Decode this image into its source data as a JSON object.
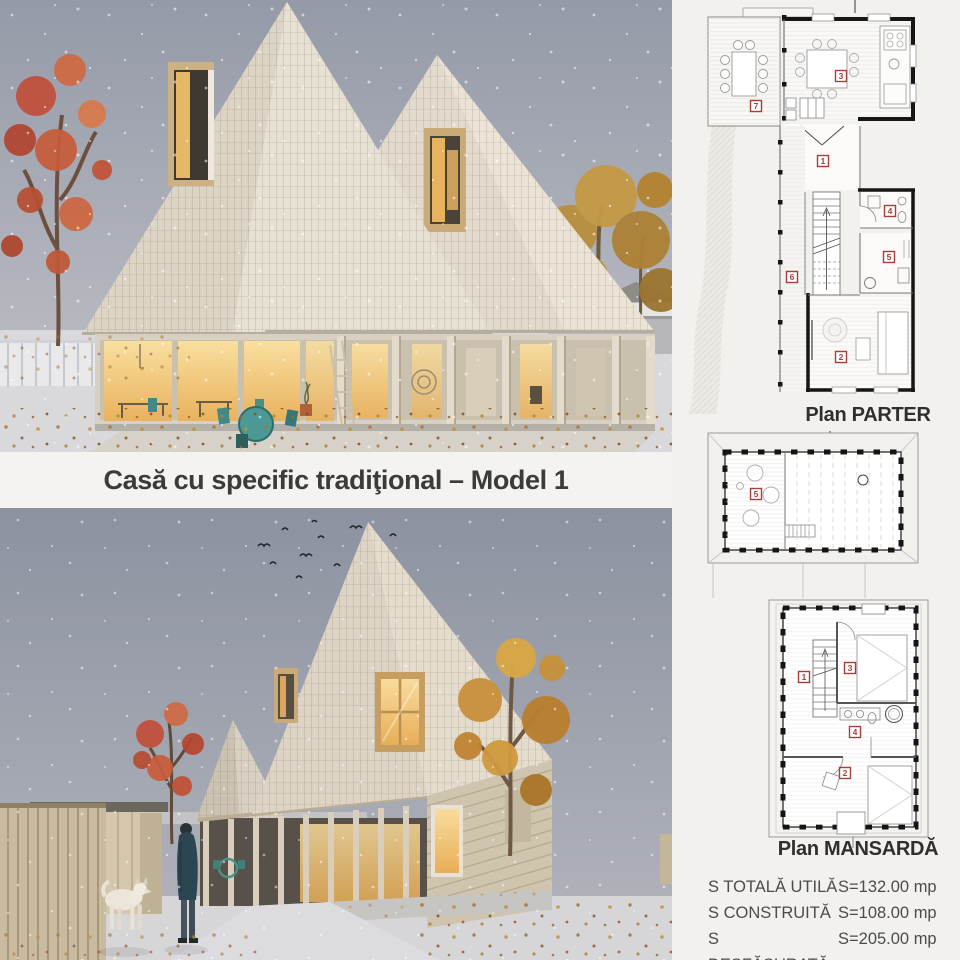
{
  "title": "Casă cu specific tradiţional – Model 1",
  "plans": {
    "parter": {
      "label": "Plan PARTER",
      "badges": [
        "7",
        "3",
        "1",
        "6",
        "4",
        "5",
        "2"
      ]
    },
    "loft": {
      "badges": [
        "5"
      ]
    },
    "mansarda": {
      "label": "Plan MANSARDĂ",
      "badges": [
        "1",
        "3",
        "4",
        "2"
      ]
    }
  },
  "stats": {
    "rows": [
      {
        "label": "S TOTALĂ UTILĂ",
        "value": "S=132.00 mp"
      },
      {
        "label": "S CONSTRUITĂ",
        "value": "S=108.00 mp"
      },
      {
        "label": "S DESFĂȘURATĂ",
        "value": "S=205.00 mp"
      }
    ]
  },
  "colors": {
    "background": "#f2f1ee",
    "badge_red": "#a53e3c",
    "wall_black": "#161616",
    "sky": "#9298a6",
    "roof_shingle": "#e4ddd0",
    "window_glow": "#f1c377",
    "autumn_red": "#c25138",
    "autumn_yellow": "#c08f3c",
    "title_text": "#3b3b3b"
  }
}
